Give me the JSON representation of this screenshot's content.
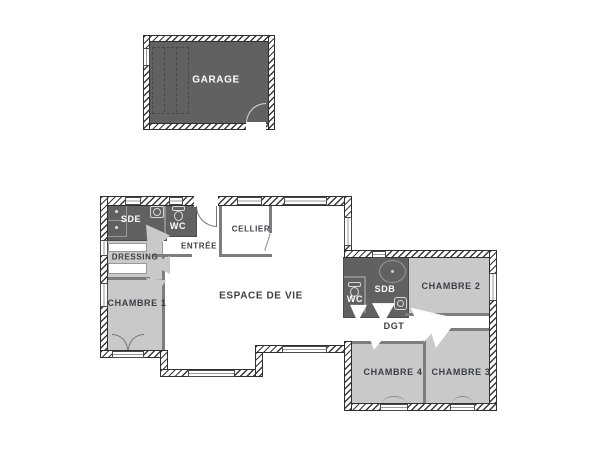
{
  "drawing": {
    "type": "floor-plan",
    "background": "#ffffff"
  },
  "palette": {
    "dark_room_fill": "#616161",
    "light_room_fill": "#c9c9c9",
    "white_room_fill": "#ffffff",
    "exterior_wall_hatch": "#3a3a3a",
    "interior_wall": "#7d7d7d",
    "label_dark": "#3d3d45",
    "label_on_dark": "#ffffff"
  },
  "rooms": {
    "garage": {
      "label": "GARAGE"
    },
    "sde": {
      "label": "SDE"
    },
    "wc_entree": {
      "label": "WC"
    },
    "entree": {
      "label": "ENTRÉE"
    },
    "cellier": {
      "label": "CELLIER"
    },
    "dressing": {
      "label": "DRESSING"
    },
    "chambre1": {
      "label": "CHAMBRE 1"
    },
    "espace_de_vie": {
      "label": "ESPACE DE VIE"
    },
    "wc_nuit": {
      "label": "WC"
    },
    "sdb": {
      "label": "SDB"
    },
    "chambre2": {
      "label": "CHAMBRE 2"
    },
    "dgt": {
      "label": "DGT"
    },
    "chambre4": {
      "label": "CHAMBRE 4"
    },
    "chambre3": {
      "label": "CHAMBRE 3"
    }
  }
}
